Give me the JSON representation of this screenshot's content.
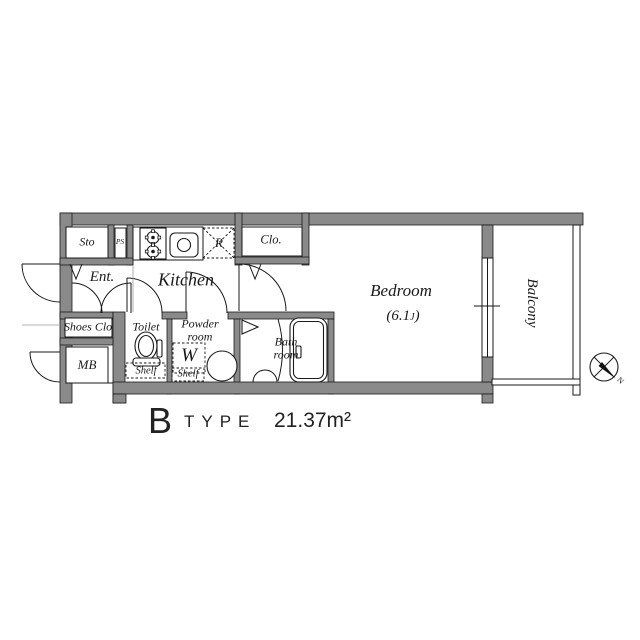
{
  "plan": {
    "rooms": {
      "sto": "Sto",
      "ps": "PS",
      "ent": "Ent.",
      "shoes_clo": "Shoes Clo",
      "mb": "MB",
      "kitchen": "Kitchen",
      "toilet": "Toilet",
      "powder_room": "Powder room",
      "bath_room": "Bath room",
      "clo": "Clo.",
      "bedroom": "Bedroom",
      "bedroom_size_open": "(6.1",
      "bedroom_size_unit": "J",
      "bedroom_size_close": ")",
      "balcony": "Balcony"
    },
    "fixtures": {
      "refrigerator": "R",
      "washer": "W",
      "toilet_shelf": "Shelf",
      "powder_shelf": "Shelf"
    },
    "compass": {
      "north": "N"
    },
    "title": {
      "letter": "B",
      "word": "TYPE",
      "area": "21.37m²"
    },
    "colors": {
      "wall": "#8a8a8a",
      "line": "#1a1a1a",
      "background": "#ffffff"
    }
  }
}
